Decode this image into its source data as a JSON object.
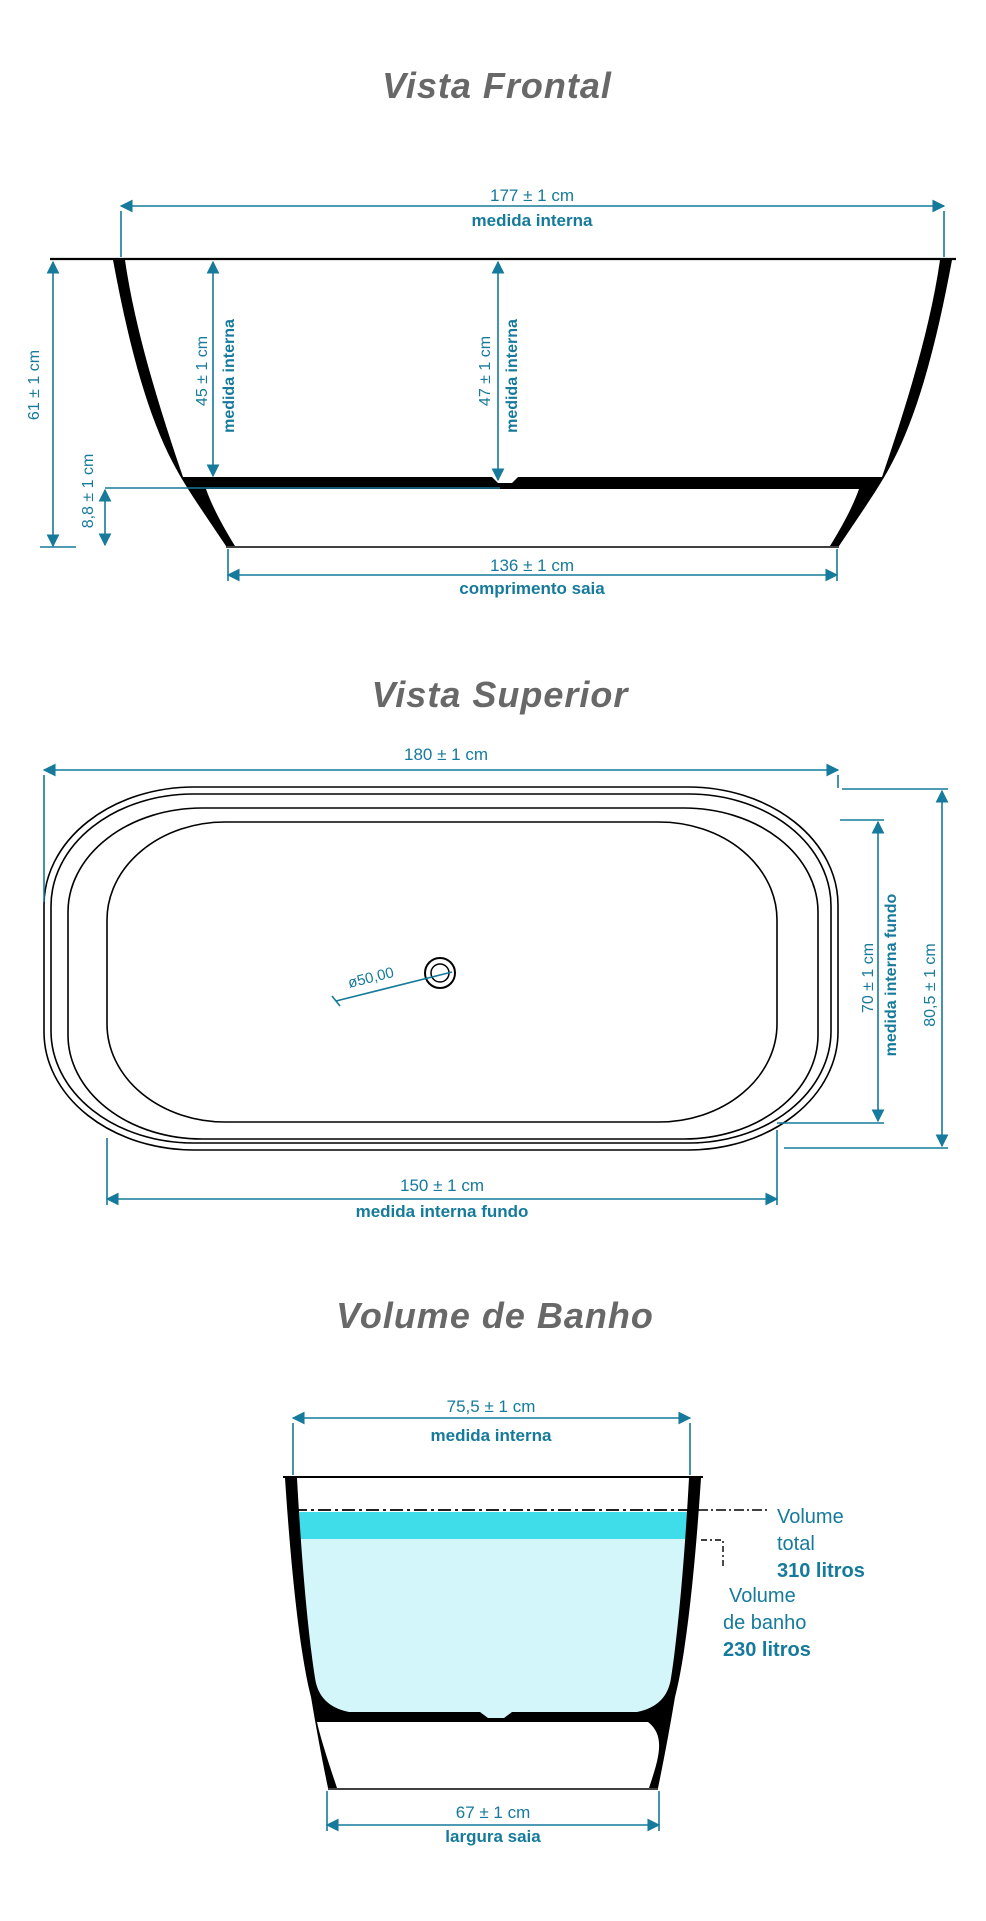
{
  "colors": {
    "dimension_teal": "#157a9b",
    "outline_black": "#000000",
    "title_gray": "#686868",
    "water_total_band": "#3edde9",
    "water_bath_body": "#d2f6fa"
  },
  "front_view": {
    "title": "Vista Frontal",
    "dim_width": "177 ± 1 cm",
    "dim_width_label": "medida interna",
    "dim_height": "61 ± 1 cm",
    "dim_depth_left": "45 ± 1 cm",
    "dim_depth_left_label": "medida interna",
    "dim_depth_center": "47 ± 1 cm",
    "dim_depth_center_label": "medida interna",
    "dim_base_height": "8,8 ± 1 cm",
    "dim_skirt_length": "136 ± 1 cm",
    "dim_skirt_label": "comprimento saia"
  },
  "top_view": {
    "title": "Vista Superior",
    "dim_length": "180 ± 1 cm",
    "dim_floor_width": "70 ± 1 cm",
    "dim_floor_width_label": "medida interna fundo",
    "dim_overall_width": "80,5 ± 1 cm",
    "dim_floor_length": "150 ± 1 cm",
    "dim_floor_length_label": "medida interna fundo",
    "drain_diameter": "ø50,00"
  },
  "volume_view": {
    "title": "Volume de Banho",
    "dim_inner_width": "75,5 ± 1 cm",
    "dim_inner_width_label": "medida interna",
    "dim_skirt_width": "67 ± 1 cm",
    "dim_skirt_width_label": "largura saia",
    "volume_total_line1": "Volume",
    "volume_total_line2": "total",
    "volume_total_value": "310 litros",
    "volume_bath_line1": "Volume",
    "volume_bath_line2": "de banho",
    "volume_bath_value": "230 litros"
  }
}
